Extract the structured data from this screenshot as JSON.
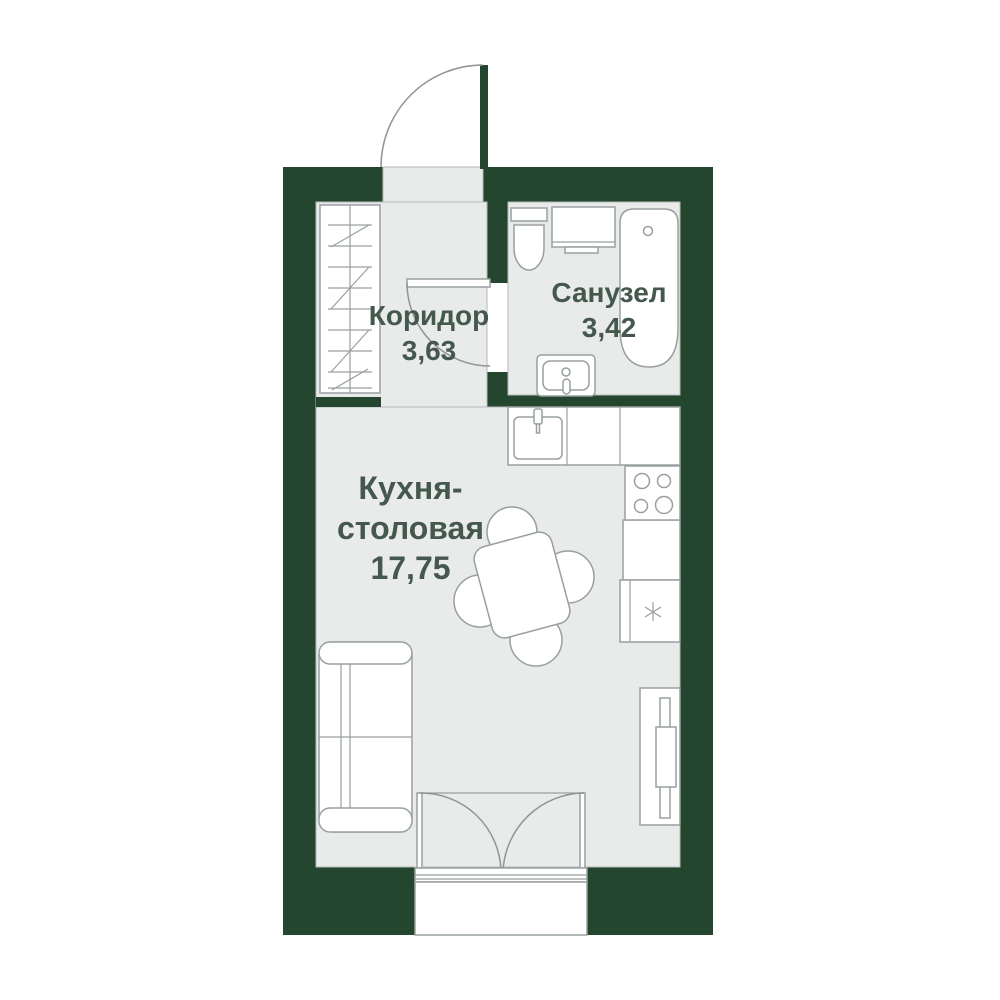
{
  "plan": {
    "title": "studio-apartment-floor-plan",
    "rooms": [
      {
        "id": "corridor",
        "name": "Коридор",
        "area": "3,63"
      },
      {
        "id": "bathroom",
        "name": "Санузел",
        "area": "3,42"
      },
      {
        "id": "kitchen",
        "name_line1": "Кухня-",
        "name_line2": "столовая",
        "area": "17,75"
      }
    ],
    "colors": {
      "wall": "#24462e",
      "floor": "#e9eaea",
      "fixture_outline": "#999f9f",
      "label_text": "#45584e",
      "background": "#ffffff"
    },
    "icons": {
      "freezer": "snowflake-asterisk"
    }
  }
}
